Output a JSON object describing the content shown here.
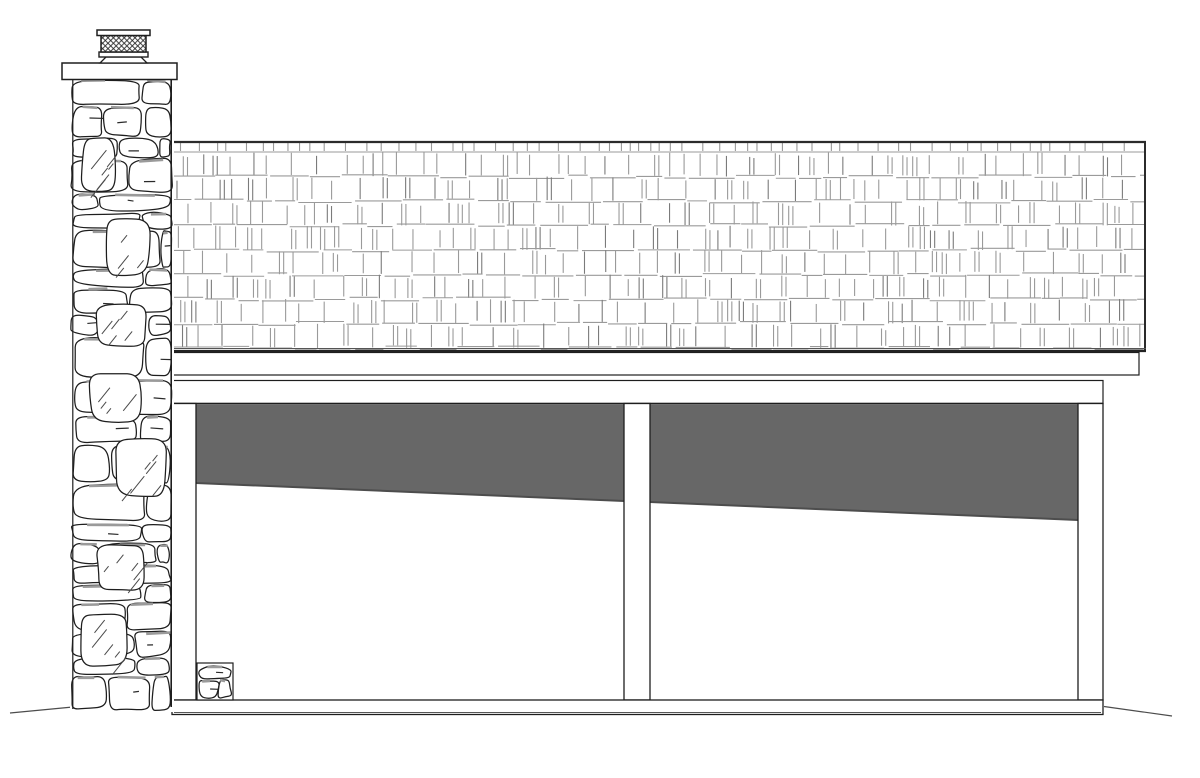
{
  "meta": {
    "drawing_type": "architectural-side-elevation",
    "subject": "two-bay garage with stone chimney, shake shingle shed roof, open bays with interior shadow"
  },
  "canvas": {
    "width": 1200,
    "height": 778,
    "background": "#ffffff"
  },
  "palette": {
    "outline": "#1e1e1e",
    "heavy_edge": "#2b2b2b",
    "shingle_light": "#9a9a9a",
    "shingle_dark": "#7b7b7b",
    "stone_outline": "#1e1e1e",
    "mortar_shadow": "#9a9a9a",
    "stone_detail": "#2a2a2a",
    "hatch": "#4a4a4a",
    "bay_shadow_fill": "#676767",
    "bay_shadow_edge": "#4d4d4d",
    "ground_line": "#4c4c4c",
    "white": "#ffffff"
  },
  "seeds": {
    "shingles": 1337421,
    "stones": 914733,
    "stoop": 5521
  },
  "roof": {
    "x0": 171,
    "x1": 1146,
    "y_top": 141,
    "y_bottom": 351,
    "ridge_thickness": 2.2,
    "right_edge_thickness": 2,
    "starter_row_bottom": 152,
    "rows": 8,
    "joint_spacing_min": 9,
    "joint_spacing_max": 31,
    "double_joint_probability": 0.45,
    "double_joint_gap": 4.2
  },
  "fascia": {
    "x0": 171,
    "x1": 1139,
    "y0": 352.5,
    "y1": 375
  },
  "header": {
    "x0": 171,
    "x1": 1103,
    "y0": 380.5,
    "y1": 403.5
  },
  "posts": {
    "left": {
      "x0": 173,
      "x1": 196,
      "y0": 403.5,
      "y1": 700
    },
    "middle": {
      "x0": 624,
      "x1": 650,
      "y0": 403.5,
      "y1": 700
    },
    "right": {
      "x0": 1078,
      "x1": 1103,
      "y0": 403.5,
      "y1": 700
    }
  },
  "bays": {
    "shadow_top": 404.5,
    "slope": {
      "x_start": 196,
      "y_start": 483,
      "x_end": 1078,
      "y_end": 520
    },
    "bay1": {
      "x0": 196,
      "x1": 624
    },
    "bay2": {
      "x0": 650,
      "x1": 1078
    }
  },
  "sill": {
    "x0": 172,
    "x1": 1103,
    "y0": 700,
    "y1": 714.5
  },
  "ground": {
    "left": {
      "x1": 10,
      "y1": 713,
      "x2": 78,
      "y2": 706.5
    },
    "right": {
      "x1": 1104,
      "y1": 706.5,
      "x2": 1172,
      "y2": 716
    }
  },
  "chimney": {
    "body": {
      "x0": 72,
      "x1": 172,
      "y0": 79,
      "y1": 711
    },
    "cap_slab": {
      "x0": 62,
      "x1": 177,
      "y0": 63,
      "y1": 79.5
    },
    "neck": {
      "top_x0": 106,
      "top_x1": 141,
      "bot_x0": 100,
      "bot_x1": 147,
      "y0": 57,
      "y1": 63
    },
    "lower_plate": {
      "x0": 99,
      "x1": 148,
      "y0": 52,
      "y1": 57
    },
    "mesh": {
      "x0": 101,
      "x1": 146,
      "y0": 35.5,
      "y1": 52,
      "cell": 5.4
    },
    "top_plate": {
      "x0": 97,
      "x1": 150,
      "y0": 30,
      "y1": 35.5
    },
    "big_hatched_stones": 7
  },
  "stoop": {
    "x0": 197,
    "x1": 233,
    "y0": 663,
    "y1": 700
  }
}
